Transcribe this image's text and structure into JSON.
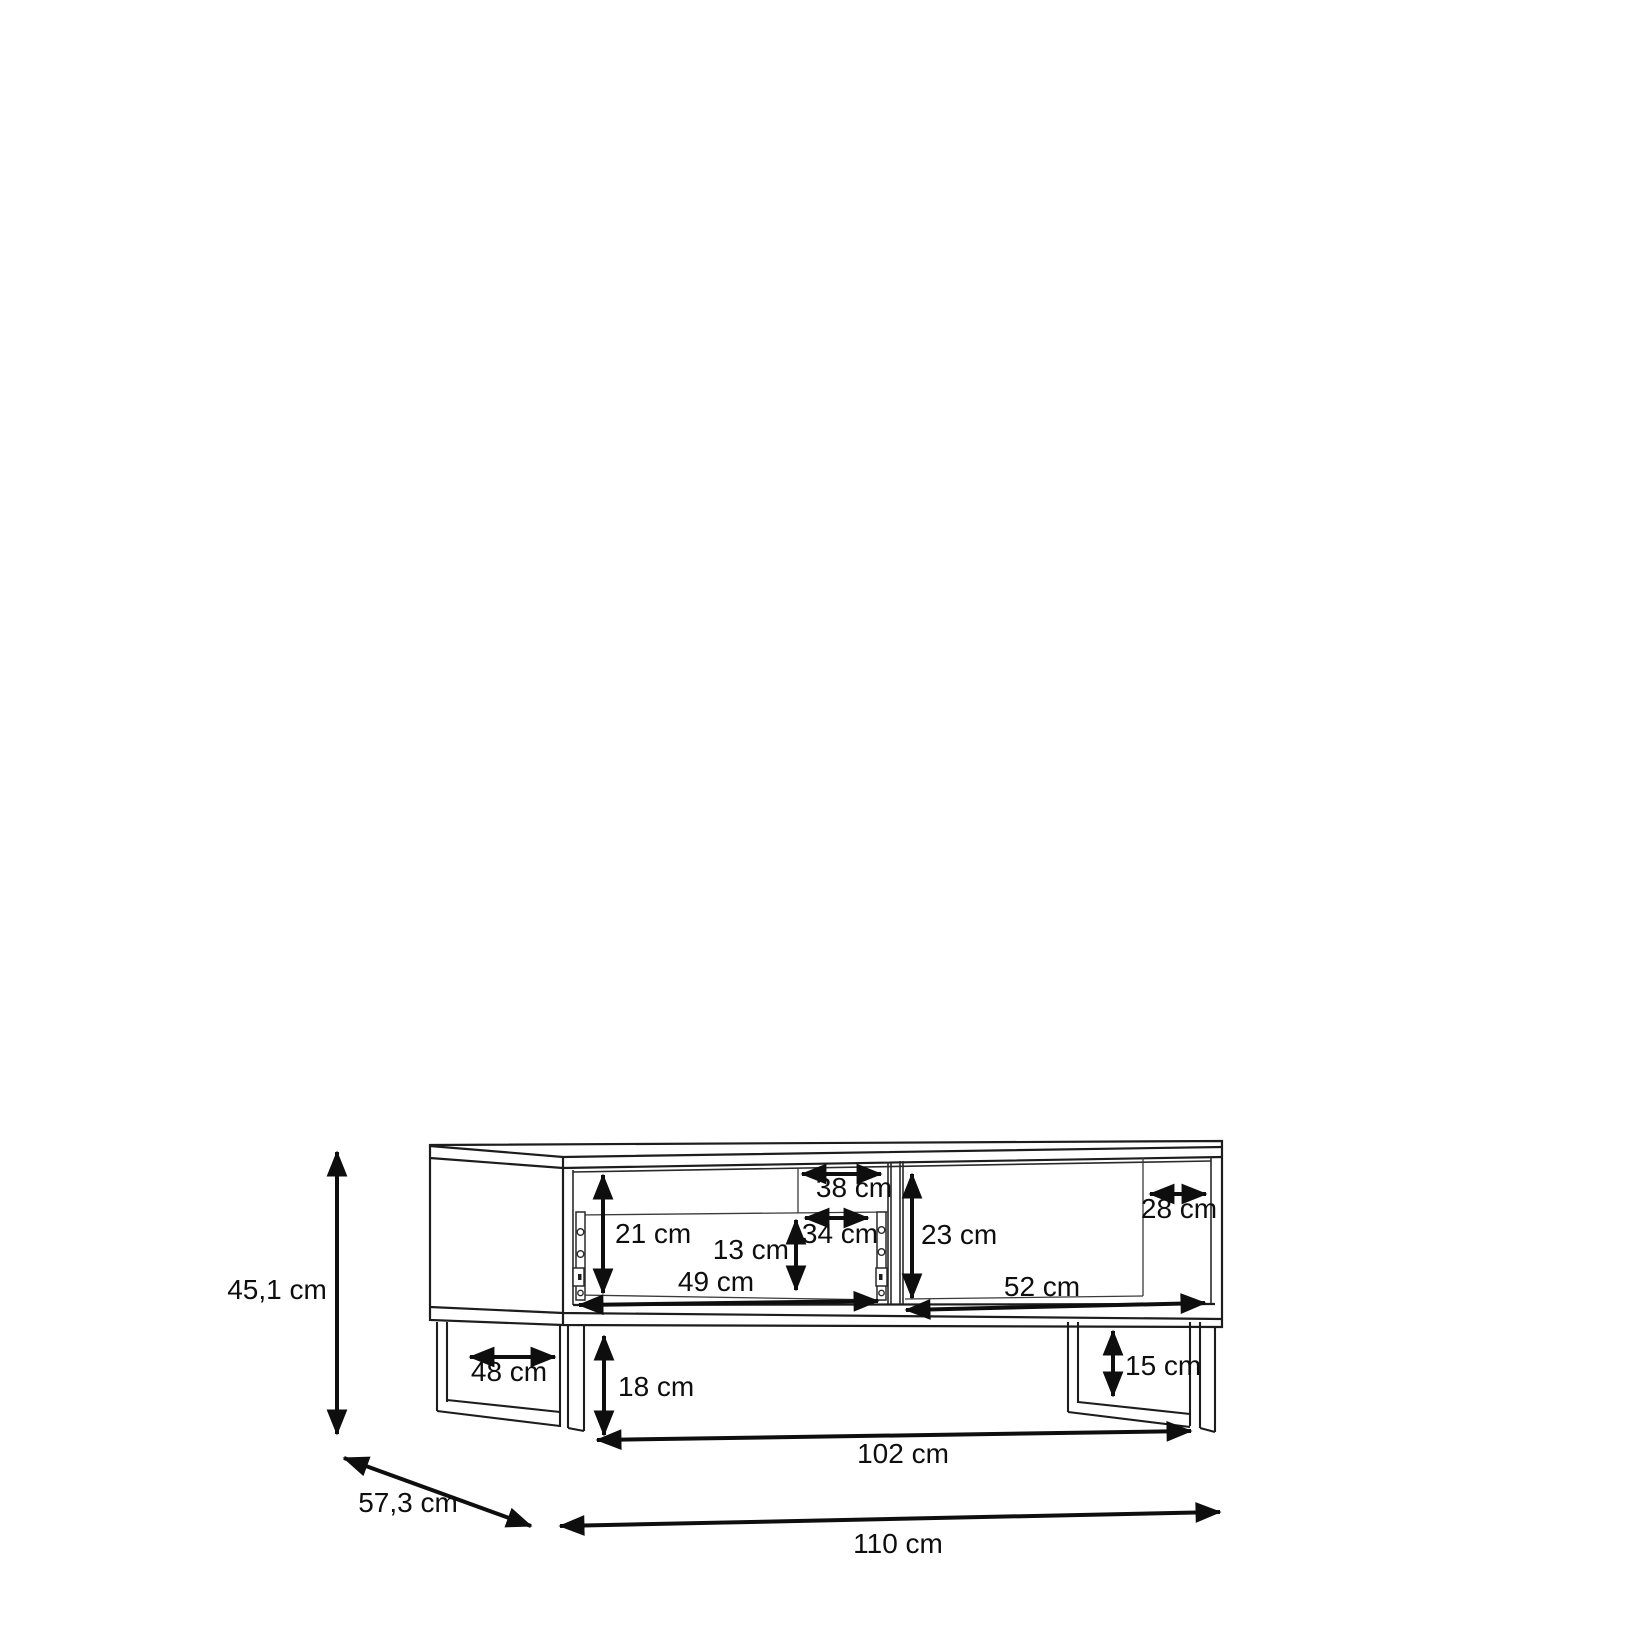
{
  "diagram": {
    "background_color": "#ffffff",
    "line_color": "#1d1d1d",
    "dimension_color": "#0e0e0e",
    "labels": {
      "height_total": "45,1 cm",
      "depth_total": "57,3 cm",
      "width_total": "110 cm",
      "base_span": "102 cm",
      "leg_inner_depth": "48 cm",
      "underbody_clearance": "18 cm",
      "leg_inner_height": "15 cm",
      "left_opening_height": "21 cm",
      "left_back_cutout_height": "13 cm",
      "left_back_cutout_width": "34 cm",
      "left_back_top_width": "38 cm",
      "right_opening_height": "23 cm",
      "right_back_depth": "28 cm",
      "left_opening_width": "49 cm",
      "right_opening_width": "52 cm"
    }
  }
}
